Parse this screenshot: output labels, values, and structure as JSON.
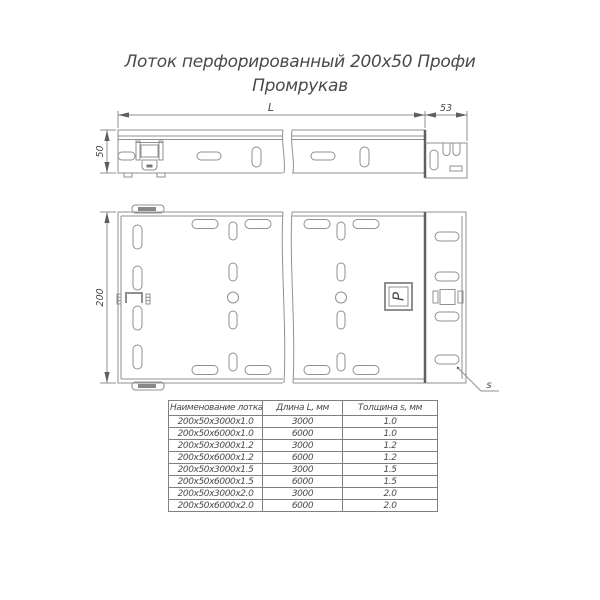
{
  "title": {
    "line1": "Лоток перфорированный 200х50 Профи",
    "line2": "Промрукав"
  },
  "drawing": {
    "side_view": {
      "length_label": "L",
      "connector_width_label": "53",
      "height_label": "50"
    },
    "top_view": {
      "width_label": "200",
      "thickness_label": "s",
      "logo_letter": "Р"
    }
  },
  "table": {
    "headers": [
      "Наименование лотка",
      "Длина L, мм",
      "Толщина s, мм"
    ],
    "rows": [
      [
        "200х50х3000х1.0",
        "3000",
        "1.0"
      ],
      [
        "200х50х6000х1.0",
        "6000",
        "1.0"
      ],
      [
        "200х50х3000х1.2",
        "3000",
        "1.2"
      ],
      [
        "200х50х6000х1.2",
        "6000",
        "1.2"
      ],
      [
        "200х50х3000х1.5",
        "3000",
        "1.5"
      ],
      [
        "200х50х6000х1.5",
        "6000",
        "1.5"
      ],
      [
        "200х50х3000х2.0",
        "3000",
        "2.0"
      ],
      [
        "200х50х6000х2.0",
        "6000",
        "2.0"
      ]
    ]
  },
  "colors": {
    "background": "#ffffff",
    "thin_line": "#8f8f8f",
    "thick_line": "#5f5f5f",
    "text": "#4a4a4a",
    "table_border": "#7f7f7f"
  }
}
